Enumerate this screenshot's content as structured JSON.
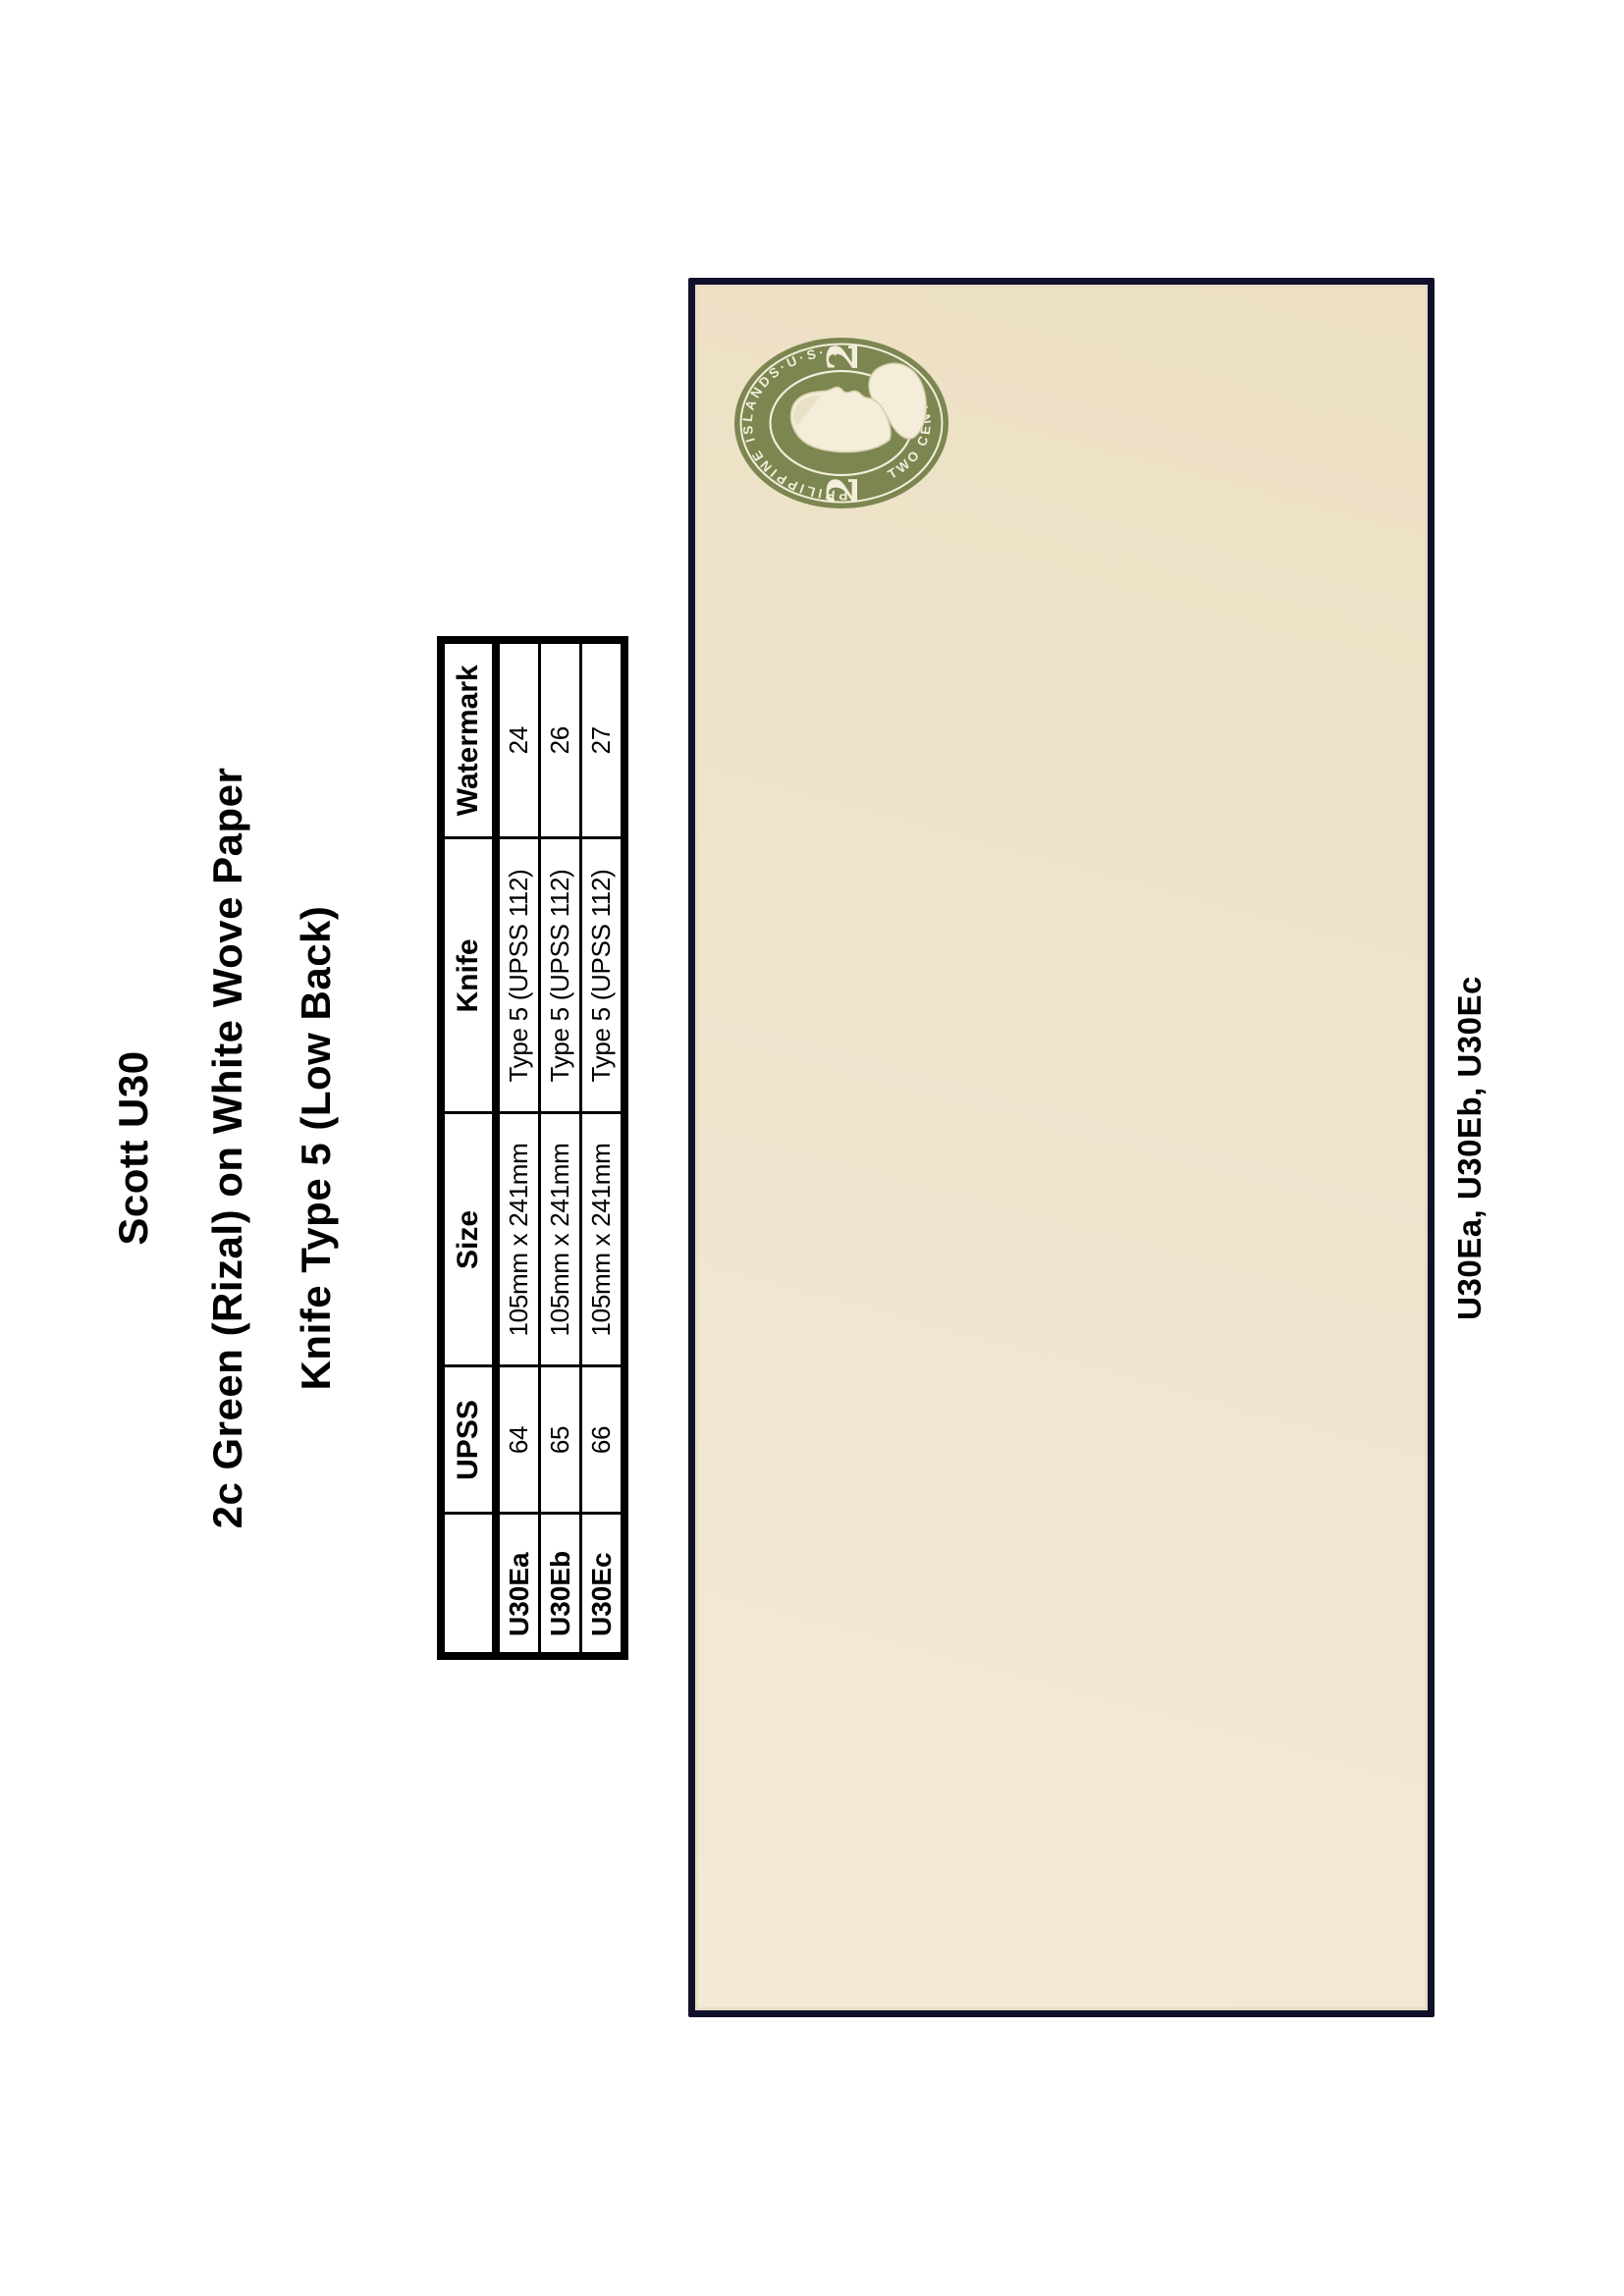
{
  "page": {
    "title": "Scott U30",
    "subtitle": "2c Green (Rizal) on White Wove Paper",
    "knife_heading": "Knife Type 5 (Low Back)"
  },
  "table": {
    "headers": [
      "",
      "UPSS",
      "Size",
      "Knife",
      "Watermark"
    ],
    "rows": [
      {
        "label": "U30Ea",
        "upss": "64",
        "size": "105mm x 241mm",
        "knife": "Type 5 (UPSS 112)",
        "watermark": "24"
      },
      {
        "label": "U30Eb",
        "upss": "65",
        "size": "105mm x 241mm",
        "knife": "Type 5 (UPSS 112)",
        "watermark": "26"
      },
      {
        "label": "U30Ec",
        "upss": "66",
        "size": "105mm x 241mm",
        "knife": "Type 5 (UPSS 112)",
        "watermark": "27"
      }
    ]
  },
  "envelope": {
    "stamp": {
      "arc_top": "PHILIPPINE ISLANDS·U·S·A·",
      "arc_bottom": "TWO CENTAVOS",
      "denomination": "2"
    }
  },
  "caption": "U30Ea, U30Eb, U30Ec",
  "colors": {
    "stamp_green": "#7c8650",
    "stamp_cream": "#f3edda",
    "envelope_paper": "#f0e6cf",
    "envelope_border": "#10102a"
  }
}
